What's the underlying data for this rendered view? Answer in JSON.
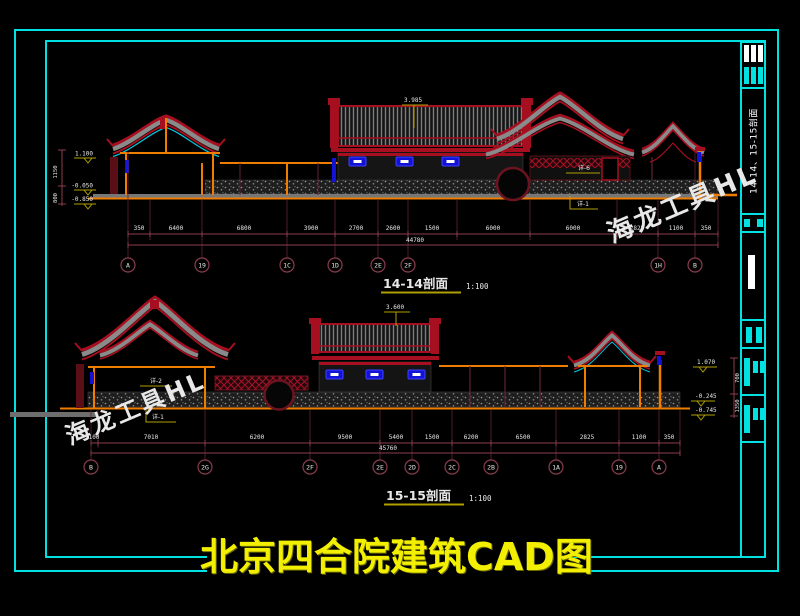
{
  "page": {
    "title": "北京四合院建筑CAD图",
    "colors": {
      "background": "#000000",
      "border_cyan": "#00e2e2",
      "roof_red": "#a60f1f",
      "frame_orange": "#ee7d00",
      "window_blue": "#1313d8",
      "dim_maroon": "#8a3d4d",
      "leader_olive": "#b0a000",
      "title_yellow": "#f2ef00"
    }
  },
  "sidebar": {
    "vertical_title": "14-14、15-15剖面"
  },
  "watermark": {
    "text": "海龙工具HL"
  },
  "sections": [
    {
      "name": "14-14剖面",
      "scale": "1:100",
      "flag": "3.985",
      "total": "44780",
      "elevations": [
        "1.100",
        "-0.050",
        "-0.850"
      ],
      "vdims": [
        "1150",
        "800"
      ],
      "leaders": [
        "详-6",
        "详-1"
      ],
      "dims": [
        "350",
        "6400",
        "6800",
        "3900",
        "2700",
        "2600",
        "1500",
        "6000",
        "6000",
        "2825",
        "1100",
        "350"
      ],
      "bubbles": [
        "A",
        "19",
        "1C",
        "1D",
        "2E",
        "2F",
        "1H",
        "B"
      ]
    },
    {
      "name": "15-15剖面",
      "scale": "1:100",
      "flag": "3.600",
      "total": "45760",
      "elevations": [
        "1.070",
        "-0.245",
        "-0.745"
      ],
      "vdims": [
        "700",
        "1350"
      ],
      "leaders": [
        "详-2",
        "详-1"
      ],
      "dims": [
        "100",
        "7010",
        "6200",
        "9500",
        "5400",
        "1500",
        "6200",
        "6500",
        "2825",
        "1100",
        "350"
      ],
      "bubbles": [
        "B",
        "2G",
        "2F",
        "2E",
        "2D",
        "2C",
        "2B",
        "1A",
        "19",
        "A"
      ]
    }
  ]
}
